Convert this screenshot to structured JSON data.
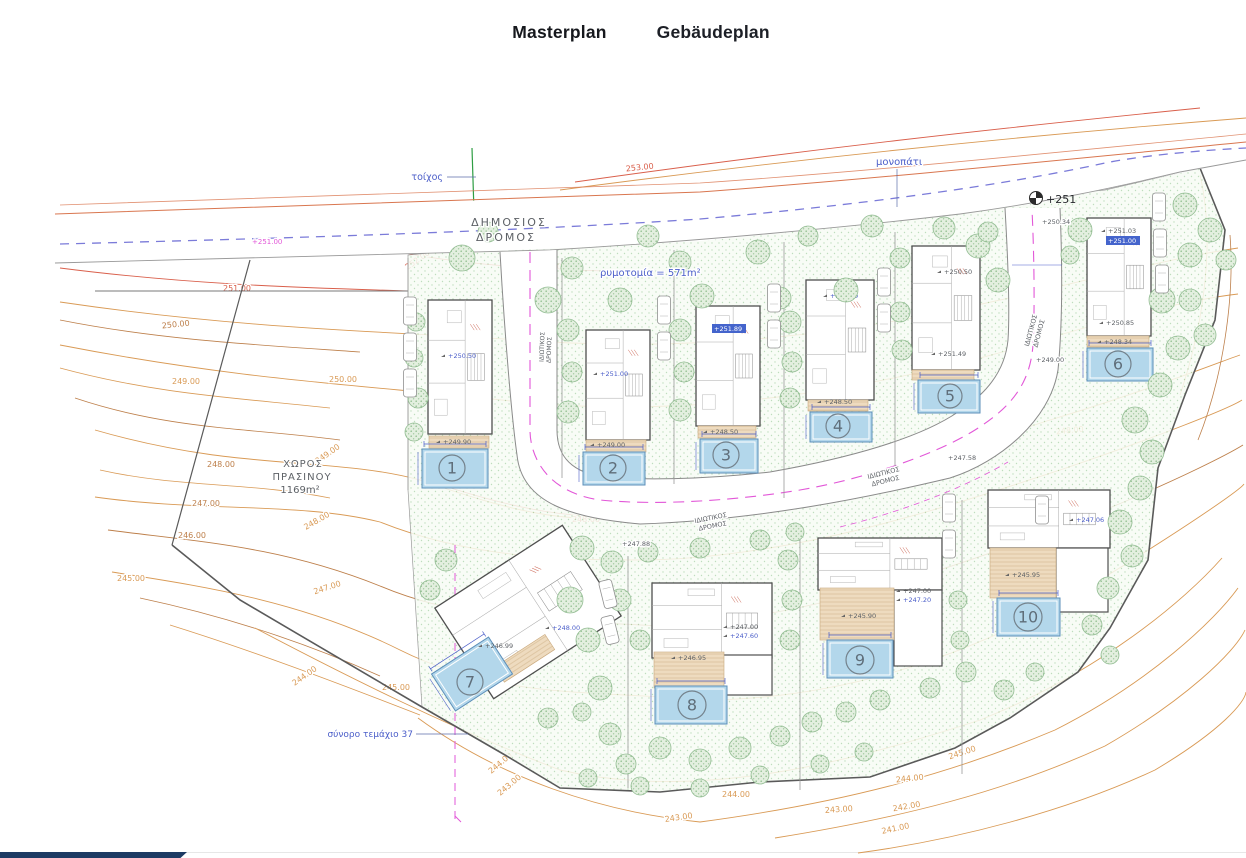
{
  "tabs": [
    {
      "label": "Masterplan",
      "active": true
    },
    {
      "label": "Gebäudeplan",
      "active": false
    }
  ],
  "colors": {
    "accent_navy": "#1d3a63",
    "pool": "#b3d7eb",
    "pool_border": "#5d8fba",
    "pool_number": "#5f6e7a",
    "tree_fill": "#e3efdf",
    "tree_dot": "#5fa05f",
    "tree_stroke": "#93bd93",
    "terrace": "#eedbbf",
    "terrace_stroke": "#c9a87c",
    "contour_orange": "#d99a55",
    "contour_brown": "#bd7f4a",
    "contour_red": "#d95f4b",
    "dashed_blue": "#7b7bd9",
    "magenta": "#e257d8",
    "label_blue": "#4b5ec9",
    "label_gray": "#5d6166",
    "boundary": "#5a5a5a",
    "house_wall": "#4f4f4f",
    "wall_green": "#2f9e44",
    "car_stroke": "#909090"
  },
  "plan": {
    "labels": [
      [
        "τοίχος",
        443,
        180,
        9.5,
        "bl",
        0,
        "e",
        0
      ],
      [
        "ΔΗΜΟΣΙΟΣ",
        509,
        226,
        11,
        "g",
        0,
        "m",
        2
      ],
      [
        "ΔΡΟΜΟΣ",
        506,
        241,
        11,
        "g",
        0,
        "m",
        2
      ],
      [
        "ρυμοτομία = 571m²",
        600,
        276,
        10,
        "bl",
        0,
        "s",
        0
      ],
      [
        "μονοπάτι",
        876,
        165,
        10,
        "bl",
        0,
        "s",
        0
      ],
      [
        "ΧΩΡΟΣ",
        303,
        467,
        10,
        "g",
        0,
        "m",
        1
      ],
      [
        "ΠΡΑΣΙΝΟΥ",
        302,
        480,
        10,
        "g",
        0,
        "m",
        1
      ],
      [
        "1169m²",
        300,
        493,
        10,
        "g",
        0,
        "m",
        0
      ],
      [
        "σύνορο τεμάχιο 37",
        413,
        737,
        9,
        "bl",
        0,
        "e",
        0
      ],
      [
        "ΙΔΙΩΤΙΚΟΣ",
        711,
        520,
        6.5,
        "g",
        -11,
        "m",
        0
      ],
      [
        "ΔΡΟΜΟΣ",
        713,
        528,
        6.5,
        "g",
        -11,
        "m",
        0
      ],
      [
        "ΙΔΙΩΤΙΚΟΣ",
        884,
        475,
        6.5,
        "g",
        -14,
        "m",
        0
      ],
      [
        "ΔΡΟΜΟΣ",
        886,
        483,
        6.5,
        "g",
        -14,
        "m",
        0
      ],
      [
        "ΙΔΙΩΤΙΚΟΣ",
        1033,
        331,
        6.5,
        "g",
        -75,
        "m",
        0
      ],
      [
        "ΔΡΟΜΟΣ",
        1041,
        334,
        6.5,
        "g",
        -75,
        "m",
        0
      ],
      [
        "ΙΔΙΩΤΙΚΟΣ",
        544,
        347,
        6,
        "g",
        -88,
        "m",
        0
      ],
      [
        "ΔΡΟΜΟΣ",
        551,
        350,
        6,
        "g",
        -88,
        "m",
        0
      ],
      [
        "+247.88",
        622,
        546,
        6.5,
        "g",
        0,
        "s",
        0
      ],
      [
        "+247.58",
        948,
        460,
        6.5,
        "g",
        0,
        "s",
        0
      ],
      [
        "+250.34",
        1042,
        224,
        6.5,
        "g",
        0,
        "s",
        0
      ],
      [
        "+249.00",
        1036,
        362,
        6.5,
        "g",
        0,
        "s",
        0
      ],
      [
        "+251.00",
        252,
        244,
        7,
        "m2",
        0,
        "s",
        0
      ]
    ],
    "benchmark": {
      "label": "+251",
      "x": 1046,
      "y": 203,
      "cx": 1036,
      "cy": 198
    },
    "contour_labels": [
      [
        "253.00",
        640,
        170,
        -6,
        "r"
      ],
      [
        "252.00",
        553,
        269,
        2,
        "r"
      ],
      [
        "252.00",
        419,
        262,
        -35,
        "r"
      ],
      [
        "251.00",
        1168,
        157,
        -6,
        "o"
      ],
      [
        "251.00",
        237,
        291,
        0,
        "r"
      ],
      [
        "250.00",
        176,
        327,
        -6,
        "b"
      ],
      [
        "250.00",
        343,
        382,
        0,
        "o"
      ],
      [
        "249.00",
        186,
        384,
        0,
        "o"
      ],
      [
        "249.00",
        329,
        456,
        -35,
        "o"
      ],
      [
        "248.00",
        221,
        467,
        0,
        "b"
      ],
      [
        "248.00",
        318,
        523,
        -30,
        "o"
      ],
      [
        "248.00",
        586,
        522,
        0,
        "r"
      ],
      [
        "247.00",
        206,
        506,
        0,
        "b"
      ],
      [
        "246.00",
        192,
        538,
        0,
        "b"
      ],
      [
        "245.00",
        131,
        581,
        0,
        "o"
      ],
      [
        "247.00",
        328,
        590,
        -18,
        "o"
      ],
      [
        "244.00",
        306,
        678,
        -35,
        "o"
      ],
      [
        "245.00",
        396,
        690,
        0,
        "o"
      ],
      [
        "244.00",
        502,
        765,
        -40,
        "o"
      ],
      [
        "243.00",
        511,
        787,
        -40,
        "o"
      ],
      [
        "244.00",
        736,
        797,
        0,
        "o"
      ],
      [
        "243.00",
        679,
        820,
        -8,
        "o"
      ],
      [
        "243.00",
        839,
        812,
        -4,
        "o"
      ],
      [
        "245.00",
        963,
        755,
        -18,
        "o"
      ],
      [
        "244.00",
        910,
        781,
        -6,
        "o"
      ],
      [
        "242.00",
        907,
        809,
        -10,
        "o"
      ],
      [
        "241.00",
        896,
        831,
        -12,
        "o"
      ],
      [
        "248.00",
        1070,
        433,
        -6,
        "o"
      ],
      [
        "247.00",
        1063,
        533,
        -28,
        "o"
      ],
      [
        "246.00",
        1076,
        607,
        -10,
        "o"
      ]
    ],
    "villas": [
      {
        "n": "1",
        "house": [
          428,
          300,
          64,
          134,
          0
        ],
        "wing": null,
        "terrace": [
          429,
          436,
          60,
          12
        ],
        "pool": [
          422,
          449,
          66,
          39,
          0
        ],
        "num": [
          452,
          468,
          13
        ],
        "ann": [
          [
            "+250.50",
            448,
            358,
            "bl"
          ],
          [
            "+249.90",
            443,
            444,
            "g"
          ]
        ]
      },
      {
        "n": "2",
        "house": [
          586,
          330,
          64,
          110,
          0
        ],
        "wing": null,
        "terrace": [
          586,
          440,
          60,
          12
        ],
        "pool": [
          583,
          452,
          62,
          33,
          0
        ],
        "num": [
          613,
          468,
          13
        ],
        "ann": [
          [
            "+251.00",
            600,
            376,
            "bl"
          ],
          [
            "+249.00",
            597,
            447,
            "g"
          ]
        ]
      },
      {
        "n": "3",
        "house": [
          696,
          306,
          64,
          120,
          0
        ],
        "wing": null,
        "terrace": [
          698,
          426,
          58,
          12
        ],
        "pool": [
          700,
          439,
          58,
          34,
          0
        ],
        "num": [
          726,
          455,
          13
        ],
        "ann": [
          [
            "+251.89",
            714,
            331,
            "B"
          ],
          [
            "+248.50",
            710,
            434,
            "g"
          ]
        ]
      },
      {
        "n": "4",
        "house": [
          806,
          280,
          68,
          120,
          0
        ],
        "wing": null,
        "terrace": [
          808,
          400,
          60,
          11
        ],
        "pool": [
          810,
          412,
          62,
          30,
          0
        ],
        "num": [
          838,
          426,
          12
        ],
        "ann": [
          [
            "+250.50",
            830,
            298,
            "bl"
          ],
          [
            "+248.50",
            824,
            404,
            "g"
          ]
        ]
      },
      {
        "n": "5",
        "house": [
          912,
          246,
          68,
          124,
          0
        ],
        "wing": null,
        "terrace": [
          912,
          370,
          62,
          10
        ],
        "pool": [
          918,
          380,
          62,
          33,
          0
        ],
        "num": [
          950,
          396,
          12
        ],
        "ann": [
          [
            "+250.50",
            944,
            274,
            "g"
          ],
          [
            "+251.49",
            938,
            356,
            "g"
          ]
        ]
      },
      {
        "n": "6",
        "house": [
          1087,
          218,
          64,
          118,
          0
        ],
        "wing": null,
        "terrace": [
          1087,
          336,
          62,
          11
        ],
        "pool": [
          1087,
          348,
          66,
          33,
          0
        ],
        "num": [
          1118,
          364,
          13
        ],
        "ann": [
          [
            "+251.03",
            1108,
            233,
            "g"
          ],
          [
            "+251.00",
            1108,
            243,
            "B"
          ],
          [
            "+250.85",
            1106,
            325,
            "g"
          ],
          [
            "+248.34",
            1104,
            344,
            "g"
          ]
        ]
      },
      {
        "n": "7",
        "house": [
          452,
          558,
          152,
          108,
          -33
        ],
        "wing": null,
        "terrace": [
          470,
          640,
          60,
          18
        ],
        "pool": [
          438,
          652,
          68,
          44,
          -33
        ],
        "num": [
          470,
          682,
          13
        ],
        "ann": [
          [
            "+246.99",
            485,
            648,
            "g"
          ],
          [
            "+248.00",
            552,
            630,
            "bl"
          ]
        ]
      },
      {
        "n": "8",
        "house": [
          652,
          583,
          120,
          75,
          0
        ],
        "wing": [
          722,
          655,
          50,
          40
        ],
        "terrace": [
          654,
          652,
          70,
          36
        ],
        "pool": [
          655,
          686,
          72,
          38,
          0
        ],
        "num": [
          692,
          705,
          14
        ],
        "ann": [
          [
            "+246.95",
            678,
            660,
            "g"
          ],
          [
            "+247.00",
            730,
            629,
            "g"
          ],
          [
            "+247.60",
            730,
            638,
            "bl"
          ]
        ]
      },
      {
        "n": "9",
        "house": [
          818,
          538,
          124,
          52,
          0
        ],
        "wing": [
          894,
          590,
          48,
          76
        ],
        "terrace": [
          820,
          588,
          74,
          52
        ],
        "pool": [
          827,
          640,
          66,
          38,
          0
        ],
        "num": [
          860,
          660,
          14
        ],
        "ann": [
          [
            "+245.90",
            848,
            618,
            "g"
          ],
          [
            "+247.00",
            903,
            593,
            "g"
          ],
          [
            "+247.20",
            903,
            602,
            "bl"
          ]
        ]
      },
      {
        "n": "10",
        "house": [
          988,
          490,
          122,
          58,
          0
        ],
        "wing": [
          1056,
          548,
          52,
          64
        ],
        "terrace": [
          990,
          548,
          66,
          50
        ],
        "pool": [
          997,
          598,
          63,
          38,
          0
        ],
        "num": [
          1028,
          617,
          14
        ],
        "ann": [
          [
            "+245.95",
            1012,
            577,
            "g"
          ],
          [
            "+247.06",
            1076,
            522,
            "bl"
          ]
        ]
      }
    ],
    "trees": [
      [
        462,
        258,
        13
      ],
      [
        488,
        232,
        10
      ],
      [
        548,
        300,
        13
      ],
      [
        572,
        268,
        11
      ],
      [
        620,
        300,
        12
      ],
      [
        648,
        236,
        11
      ],
      [
        680,
        262,
        11
      ],
      [
        702,
        296,
        12
      ],
      [
        758,
        252,
        12
      ],
      [
        780,
        298,
        11
      ],
      [
        808,
        236,
        10
      ],
      [
        846,
        290,
        12
      ],
      [
        872,
        226,
        11
      ],
      [
        900,
        258,
        10
      ],
      [
        944,
        228,
        11
      ],
      [
        978,
        246,
        12
      ],
      [
        998,
        280,
        12
      ],
      [
        988,
        232,
        10
      ],
      [
        1080,
        230,
        12
      ],
      [
        1070,
        255,
        9
      ],
      [
        1185,
        205,
        12
      ],
      [
        1210,
        230,
        12
      ],
      [
        1226,
        260,
        10
      ],
      [
        1190,
        255,
        12
      ],
      [
        1162,
        300,
        13
      ],
      [
        1190,
        300,
        11
      ],
      [
        1205,
        335,
        11
      ],
      [
        1178,
        348,
        12
      ],
      [
        1160,
        385,
        12
      ],
      [
        1135,
        420,
        13
      ],
      [
        1152,
        452,
        12
      ],
      [
        1140,
        488,
        12
      ],
      [
        1120,
        522,
        12
      ],
      [
        1132,
        556,
        11
      ],
      [
        1108,
        588,
        11
      ],
      [
        1092,
        625,
        10
      ],
      [
        1110,
        655,
        9
      ],
      [
        568,
        330,
        11
      ],
      [
        572,
        372,
        10
      ],
      [
        568,
        412,
        11
      ],
      [
        680,
        330,
        11
      ],
      [
        684,
        372,
        10
      ],
      [
        680,
        410,
        11
      ],
      [
        790,
        322,
        11
      ],
      [
        792,
        362,
        10
      ],
      [
        790,
        398,
        10
      ],
      [
        900,
        312,
        10
      ],
      [
        902,
        350,
        10
      ],
      [
        416,
        322,
        9
      ],
      [
        414,
        358,
        9
      ],
      [
        418,
        398,
        10
      ],
      [
        414,
        432,
        9
      ],
      [
        582,
        548,
        12
      ],
      [
        612,
        562,
        11
      ],
      [
        648,
        552,
        10
      ],
      [
        700,
        548,
        10
      ],
      [
        760,
        540,
        10
      ],
      [
        795,
        532,
        9
      ],
      [
        570,
        600,
        13
      ],
      [
        588,
        640,
        12
      ],
      [
        600,
        688,
        12
      ],
      [
        610,
        734,
        11
      ],
      [
        626,
        764,
        10
      ],
      [
        660,
        748,
        11
      ],
      [
        700,
        760,
        11
      ],
      [
        740,
        748,
        11
      ],
      [
        780,
        736,
        10
      ],
      [
        812,
        722,
        10
      ],
      [
        846,
        712,
        10
      ],
      [
        880,
        700,
        10
      ],
      [
        930,
        688,
        10
      ],
      [
        966,
        672,
        10
      ],
      [
        1004,
        690,
        10
      ],
      [
        1035,
        672,
        9
      ],
      [
        788,
        560,
        10
      ],
      [
        792,
        600,
        10
      ],
      [
        790,
        640,
        10
      ],
      [
        958,
        600,
        9
      ],
      [
        960,
        640,
        9
      ],
      [
        588,
        778,
        9
      ],
      [
        640,
        786,
        9
      ],
      [
        700,
        788,
        9
      ],
      [
        760,
        775,
        9
      ],
      [
        820,
        764,
        9
      ],
      [
        864,
        752,
        9
      ],
      [
        446,
        560,
        11
      ],
      [
        430,
        590,
        10
      ],
      [
        620,
        600,
        11
      ],
      [
        640,
        640,
        10
      ],
      [
        548,
        718,
        10
      ],
      [
        582,
        712,
        9
      ]
    ],
    "cars": [
      [
        410,
        311,
        0
      ],
      [
        410,
        347,
        0
      ],
      [
        410,
        383,
        0
      ],
      [
        664,
        310,
        0
      ],
      [
        664,
        346,
        0
      ],
      [
        774,
        298,
        0
      ],
      [
        774,
        334,
        0
      ],
      [
        884,
        282,
        0
      ],
      [
        884,
        318,
        0
      ],
      [
        1159,
        207,
        0
      ],
      [
        1160,
        243,
        0
      ],
      [
        1162,
        279,
        0
      ],
      [
        608,
        594,
        -14
      ],
      [
        610,
        630,
        -14
      ],
      [
        949,
        508,
        0
      ],
      [
        949,
        544,
        0
      ],
      [
        1042,
        510,
        0
      ]
    ],
    "leaders": [
      [
        447,
        177,
        476,
        177
      ],
      [
        897,
        169,
        897,
        207
      ],
      [
        416,
        734,
        468,
        734
      ]
    ]
  },
  "footer": {}
}
